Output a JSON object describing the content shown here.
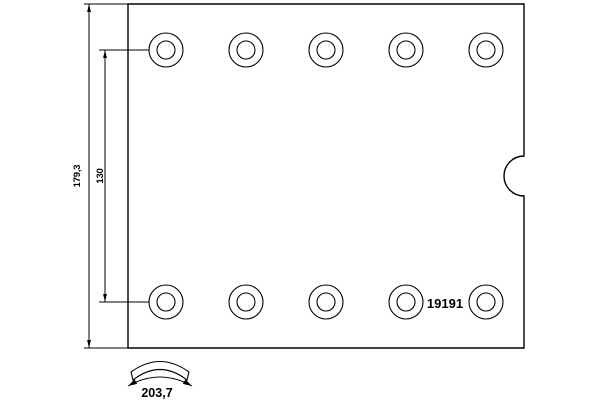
{
  "drawing": {
    "part_number": "19191",
    "dimensions": {
      "overall_width": "179,3",
      "rivet_hole_spacing": "130",
      "arc_length": "203,7"
    },
    "rivet_holes": {
      "rows": 2,
      "per_row": 5,
      "total": 10
    },
    "colors": {
      "line": "#000000",
      "background": "#ffffff"
    }
  }
}
